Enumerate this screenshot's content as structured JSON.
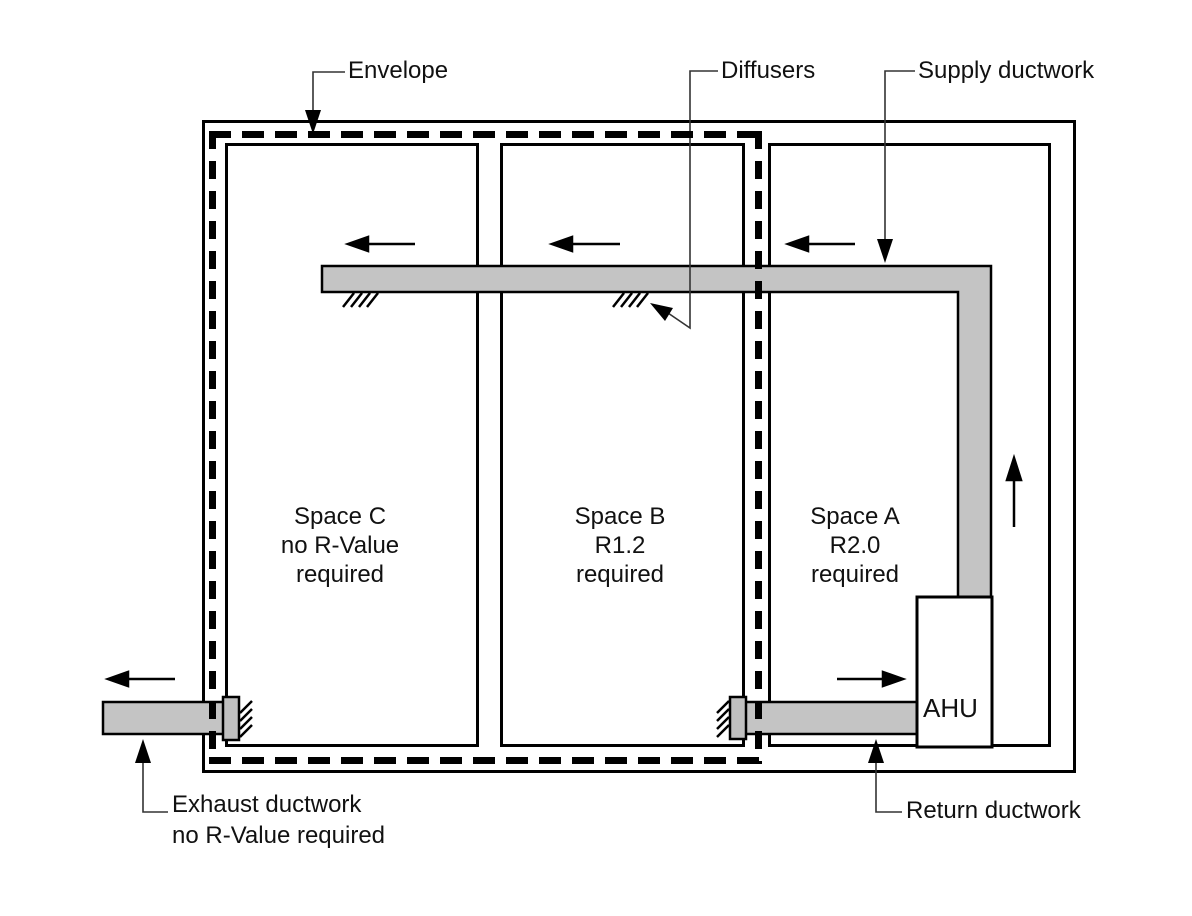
{
  "diagram": {
    "labels": {
      "envelope": "Envelope",
      "diffusers": "Diffusers",
      "supply_ductwork": "Supply ductwork",
      "exhaust_line1": "Exhaust ductwork",
      "exhaust_line2": "no R-Value required",
      "return_ductwork": "Return ductwork",
      "ahu": "AHU"
    },
    "spaces": [
      {
        "name": "Space C",
        "requirement": "no R-Value",
        "suffix": "required"
      },
      {
        "name": "Space B",
        "requirement": "R1.2",
        "suffix": "required"
      },
      {
        "name": "Space A",
        "requirement": "R2.0",
        "suffix": "required"
      }
    ],
    "colors": {
      "duct_fill": "#c4c4c4",
      "line": "#000000",
      "background": "#ffffff"
    }
  }
}
